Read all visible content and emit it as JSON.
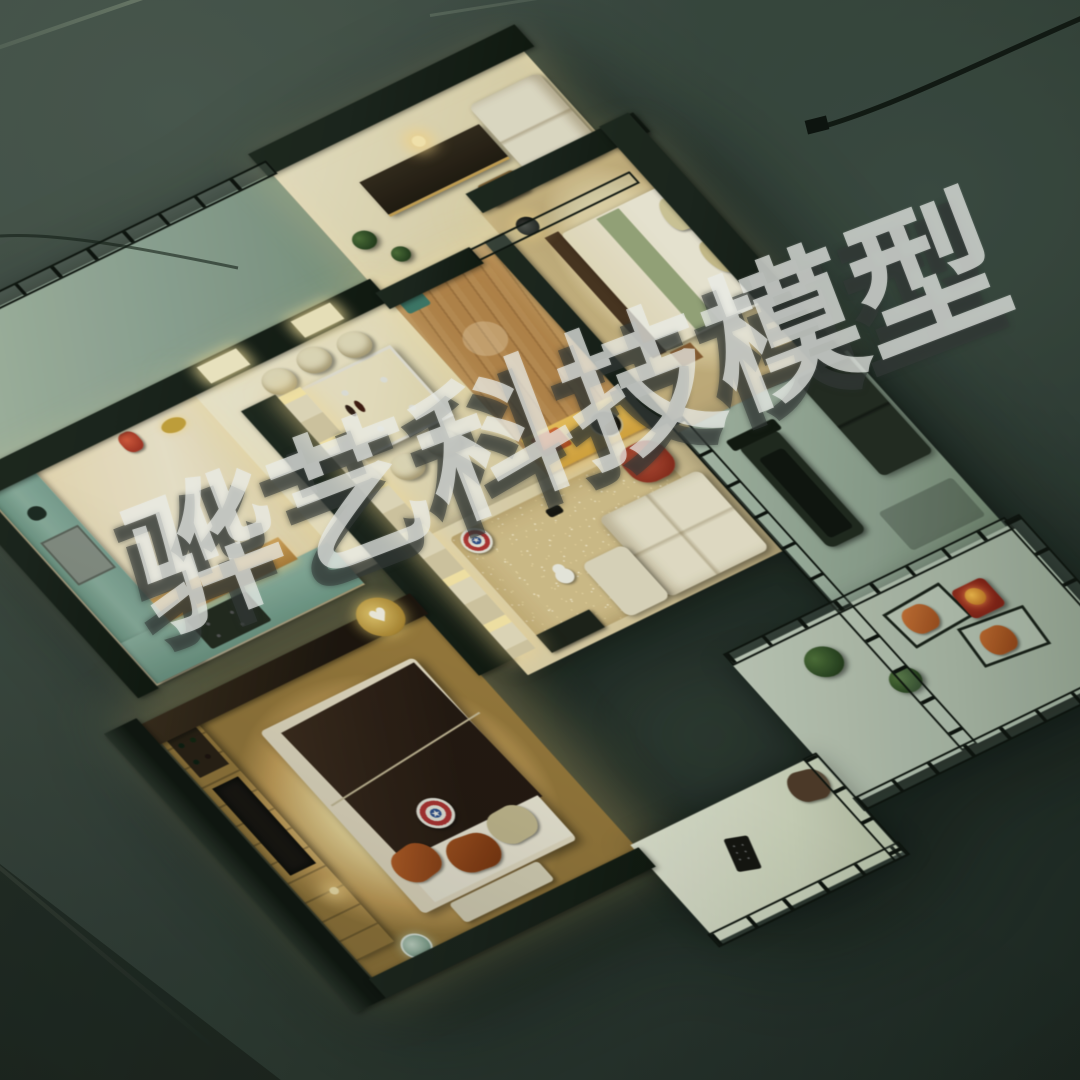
{
  "watermark": {
    "text": "骅艺科技模型",
    "color": "#e7e9e5",
    "shadow_color": "#343a38",
    "rotation_deg": -21
  },
  "icons": {
    "shield_star": "★",
    "heart": "♥"
  },
  "palette": {
    "background_top": "#46524a",
    "background_mid": "#303d35",
    "background_bottom": "#1c2520",
    "wall_top_dark": "#151d16",
    "floor_warm_cream": "#efe8cc",
    "warm_led_glow": "#ffe9a8",
    "wood_brown": "#b9874b",
    "glass_green": "#8fb9a5",
    "sparkle_carpet_gold": "#d7c28c",
    "cushion_orange": "#bf6a2e",
    "armchair_red": "#a33c28",
    "shield_red": "#b23232",
    "shield_blue": "#2e4f8e",
    "topiary_green": "#2c4722",
    "cable_black": "#0a0f0a"
  }
}
